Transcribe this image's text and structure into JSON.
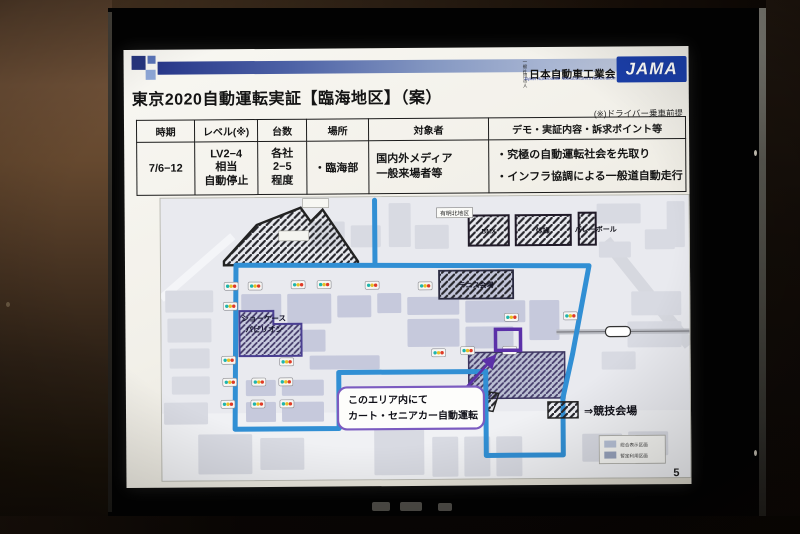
{
  "slide": {
    "logo": {
      "org_prefix_lines": [
        "一般",
        "社団法人"
      ],
      "org_name": "日本自動車工業会",
      "org_en": "Japan Automobile Manufacturers Association, Inc.",
      "acronym": "JAMA"
    },
    "title": "東京2020自動運転実証【臨海地区】（案）",
    "note": "(※)ドライバー乗車前提",
    "page_number": "5",
    "table": {
      "headers": [
        "時期",
        "レベル(※)",
        "台数",
        "場所",
        "対象者",
        "デモ・実証内容・訴求ポイント等"
      ],
      "row": {
        "period": "7/6−12",
        "level_lines": [
          "LV2−4",
          "相当",
          "自動停止"
        ],
        "units_lines": [
          "各社",
          "2−5",
          "程度"
        ],
        "place": "・臨海部",
        "audience_lines": [
          "国内外メディア",
          "一般来場者等"
        ],
        "demo_lines": [
          "・究極の自動運転社会を先取り",
          "・インフラ協調による一般道自動走行"
        ]
      }
    },
    "map": {
      "district_label": "有明北地区",
      "venue_boxes": [
        "BMX",
        "体操",
        "バレーボール"
      ],
      "tennis_label": "テニス会場",
      "pavilion_lines": [
        "ショーケース",
        "パビリオン"
      ],
      "callout_lines": [
        "このエリア内にて",
        "カート・セニアカー自動運転"
      ],
      "legend_text": "⇒競技会場",
      "mini_legend": [
        "総合表示区画",
        "暫定利用区画"
      ]
    },
    "colors": {
      "route_blue": "#318fd4",
      "accent_purple": "#5b30a8",
      "callout_purple": "#7b5bc0",
      "header_navy": "#26357e",
      "jama_blue": "#1b3faa",
      "signal_teal": "#1fb5ad",
      "signal_yellow": "#e6c027",
      "signal_red": "#e03a26"
    }
  }
}
